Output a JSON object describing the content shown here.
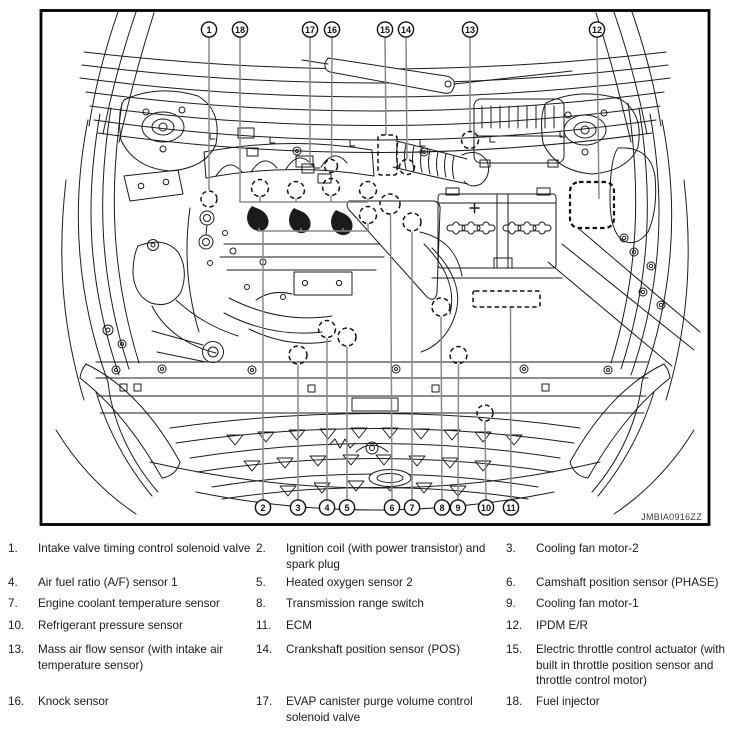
{
  "figure": {
    "code": "JMBIA0916ZZ",
    "callouts": {
      "top": [
        "1",
        "18",
        "17",
        "16",
        "15",
        "14",
        "13",
        "12"
      ],
      "bottom": [
        "2",
        "3",
        "4",
        "5",
        "6",
        "7",
        "8",
        "9",
        "10",
        "11"
      ]
    }
  },
  "legend": {
    "rows": [
      [
        {
          "num": "1.",
          "text": "Intake valve timing control solenoid valve"
        },
        {
          "num": "2.",
          "text": "Ignition coil (with power transistor) and spark plug"
        },
        {
          "num": "3.",
          "text": "Cooling fan motor-2"
        }
      ],
      [
        {
          "num": "4.",
          "text": "Air fuel ratio (A/F) sensor 1"
        },
        {
          "num": "5.",
          "text": "Heated oxygen sensor 2"
        },
        {
          "num": "6.",
          "text": "Camshaft position sensor (PHASE)"
        }
      ],
      [
        {
          "num": "7.",
          "text": "Engine coolant temperature sensor"
        },
        {
          "num": "8.",
          "text": "Transmission range switch"
        },
        {
          "num": "9.",
          "text": "Cooling fan motor-1"
        }
      ],
      [
        {
          "num": "10.",
          "text": "Refrigerant pressure sensor"
        },
        {
          "num": "11.",
          "text": "ECM"
        },
        {
          "num": "12.",
          "text": "IPDM E/R"
        }
      ],
      [
        {
          "num": "13.",
          "text": "Mass air flow sensor (with intake air temperature sensor)"
        },
        {
          "num": "14.",
          "text": "Crankshaft position sensor (POS)"
        },
        {
          "num": "15.",
          "text": "Electric throttle control actuator (with built in throttle position sensor and throttle control motor)"
        }
      ],
      [
        {
          "num": "16.",
          "text": "Knock sensor"
        },
        {
          "num": "17.",
          "text": "EVAP canister purge volume control solenoid valve"
        },
        {
          "num": "18.",
          "text": "Fuel injector"
        }
      ]
    ]
  },
  "colors": {
    "line": "#1b1b1b",
    "leader": "#8a8a8a",
    "background": "#ffffff"
  }
}
